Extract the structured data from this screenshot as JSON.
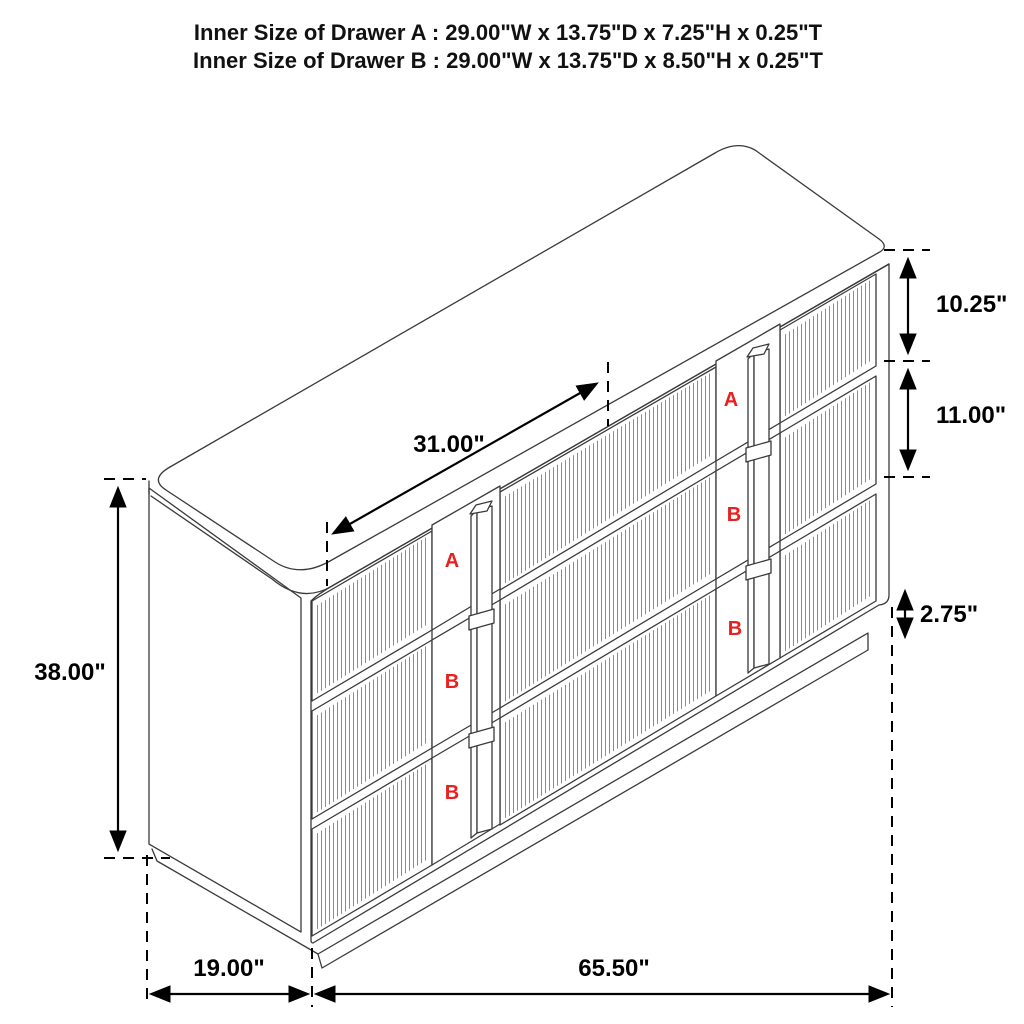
{
  "header": {
    "line1": "Inner Size of Drawer A : 29.00\"W x 13.75\"D x 7.25\"H x 0.25\"T",
    "line2": "Inner Size of Drawer B : 29.00\"W x 13.75\"D x 8.50\"H x 0.25\"T"
  },
  "dimensions": {
    "overall_height": "38.00\"",
    "top_drawer_height": "10.25\"",
    "middle_drawer_height": "11.00\"",
    "base_height": "2.75\"",
    "drawer_front_width": "31.00\"",
    "overall_depth": "19.00\"",
    "overall_width": "65.50\""
  },
  "drawer_labels": {
    "left_column": [
      "A",
      "B",
      "B"
    ],
    "right_column": [
      "A",
      "B",
      "B"
    ]
  },
  "colors": {
    "line": "#3a3a3a",
    "dimension": "#000000",
    "label_red": "#e8201f",
    "background": "#ffffff"
  }
}
